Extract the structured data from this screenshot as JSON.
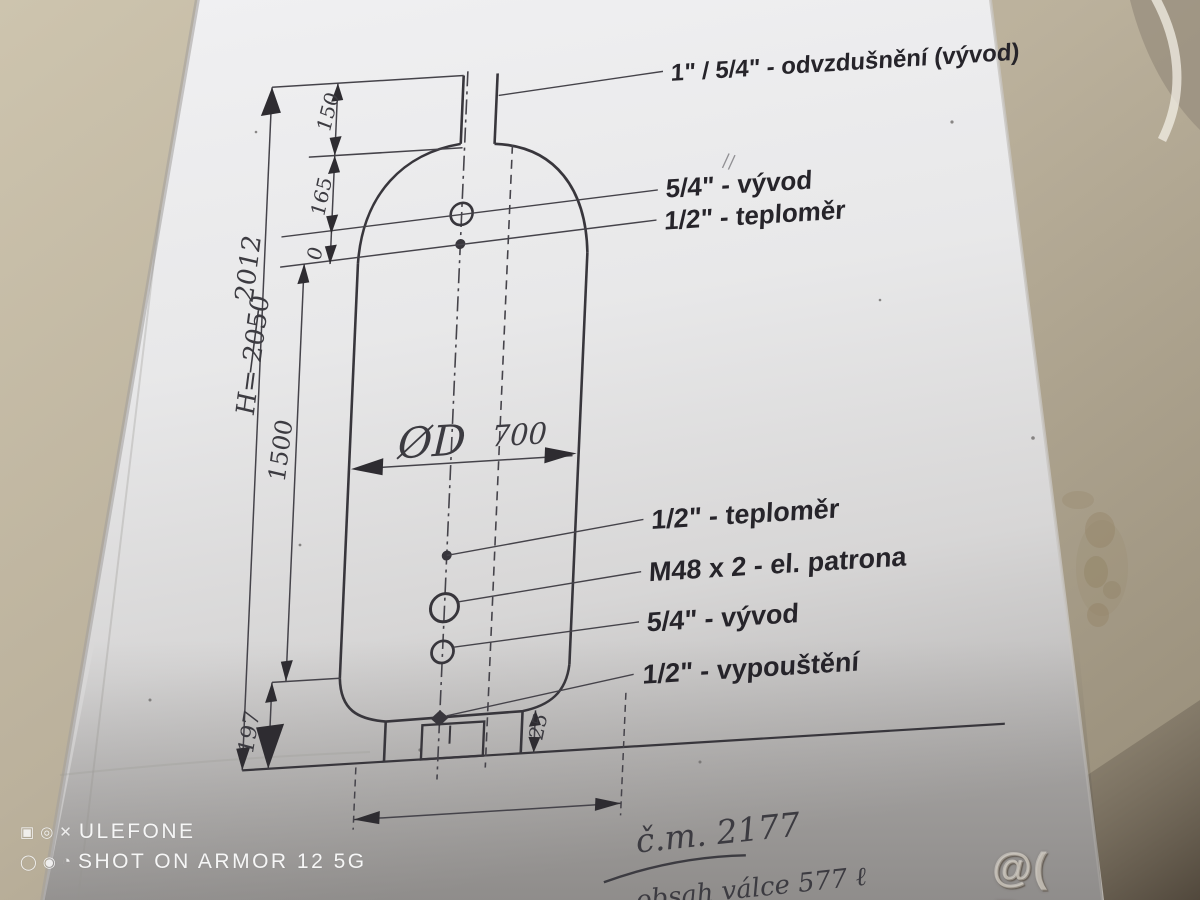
{
  "watermarks": {
    "camera_brand": "ULEFONE",
    "camera_caption": "SHOT ON ARMOR 12 5G",
    "site": "@( Bazos.cz"
  },
  "drawing": {
    "labels": {
      "vent": "1\" / 5/4\" - odvzdušnění (vývod)",
      "outlet_top": "5/4\" - vývod",
      "thermometer_top": "1/2\" - teploměr",
      "thermometer_mid": "1/2\" - teploměr",
      "heater": "M48 x 2 - el. patrona",
      "outlet_bottom": "5/4\" - vývod",
      "drain": "1/2\" - vypouštění"
    },
    "dims": {
      "total_height": "H= 2050",
      "total_height_corrected": "2012",
      "shell_height": "1500",
      "bottom_offset": "197",
      "vent_height": "150",
      "top_offset": "165",
      "datum": "0",
      "diameter_symbol": "ØD",
      "diameter_value": "700",
      "skirt_detail": "25"
    },
    "notes": {
      "number": "č.m. 2177",
      "volume": "obsah válce 577 ℓ"
    }
  }
}
